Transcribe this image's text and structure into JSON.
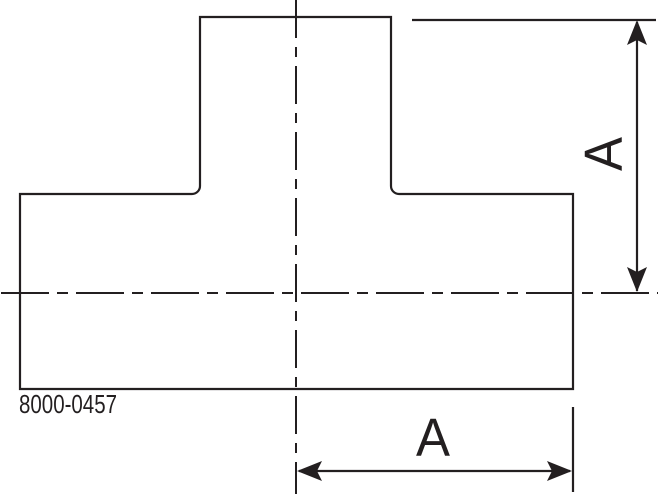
{
  "drawing": {
    "part_number": "8000-0457",
    "dimensions": {
      "vertical_label": "A",
      "horizontal_label": "A"
    },
    "colors": {
      "line": "#231f20",
      "background": "#ffffff"
    }
  }
}
